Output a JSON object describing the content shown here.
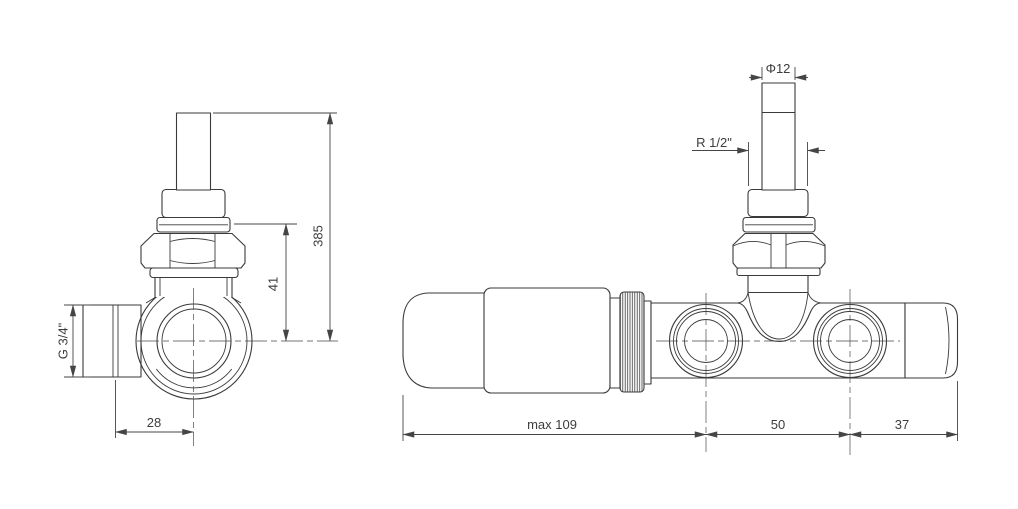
{
  "drawing_type": "valve technical drawing, two orthographic views",
  "colors": {
    "background": "#ffffff",
    "line": "#3a3a3a",
    "dimension_line": "#454545",
    "dimension_text": "#3d3d3d"
  },
  "side_view": {
    "dim_total_height": "385",
    "dim_union_to_center": "41",
    "dim_center_to_thread": "28",
    "side_thread_label": "G 3/4\""
  },
  "front_view": {
    "dim_pipe_diameter": "Φ12",
    "top_thread_label": "R 1/2\"",
    "dim_head_length": "max 109",
    "dim_port_spacing": "50",
    "dim_tail_length": "37"
  }
}
